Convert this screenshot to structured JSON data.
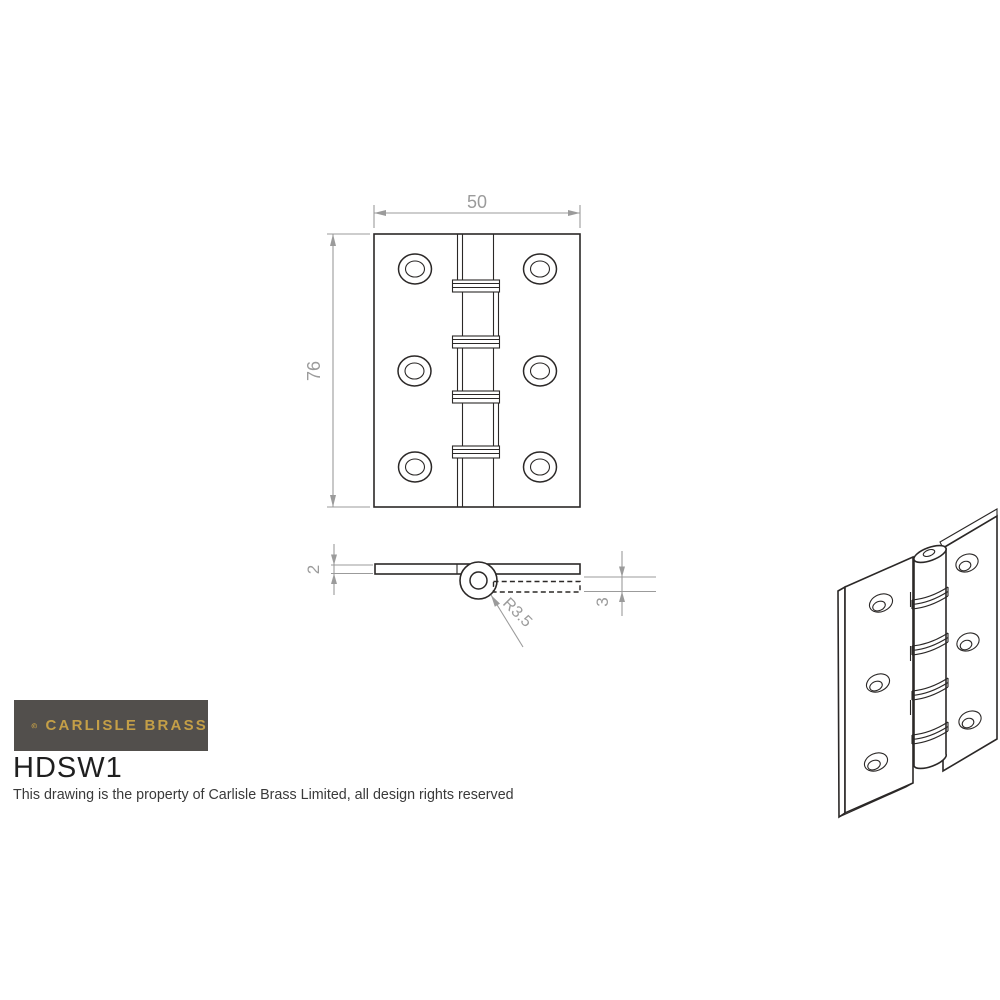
{
  "title_block": {
    "brand": "CARLISLE BRASS",
    "product_code": "HDSW1",
    "property_notice": "This drawing is the property of Carlisle Brass Limited, all design rights reserved"
  },
  "dimensions": {
    "width": "50",
    "height": "76",
    "leaf_thickness": "2",
    "lower_leaf_thickness": "3",
    "knuckle_radius": "R3.5"
  },
  "colors": {
    "line": "#2b2827",
    "dimension": "#9b9b9b",
    "logo_background": "#524f4c",
    "brand_gold": "#c49f47"
  }
}
